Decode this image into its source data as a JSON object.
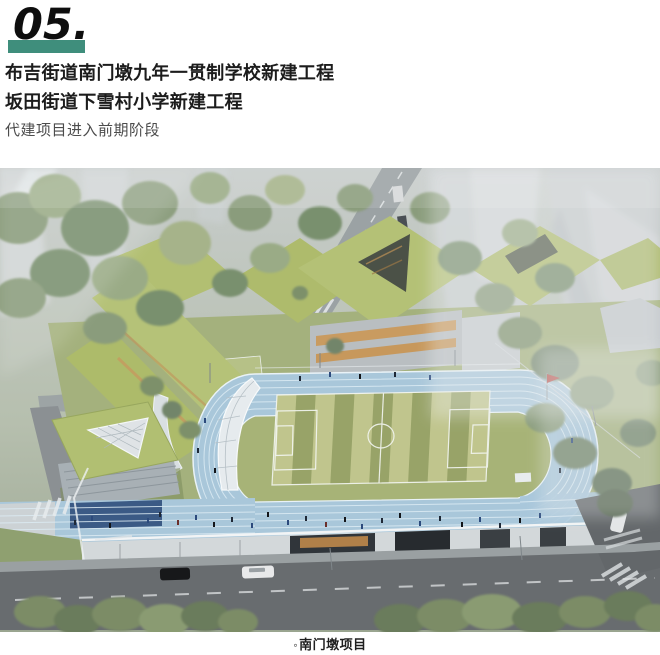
{
  "header": {
    "section_number": "05.",
    "accent_color": "#3F8E7C",
    "title_line1": "布吉街道南门墩九年一贯制学校新建工程",
    "title_line2": "坂田街道下雪村小学新建工程",
    "subtitle": "代建项目进入前期阶段"
  },
  "figure": {
    "alt": "学校新建项目鸟瞰效果图：绿色屋顶教学楼、蓝色环形跑道与足球场",
    "caption_bullet": "◦",
    "caption_text": "南门墩项目",
    "colors": {
      "track_blue": "#A9C7DA",
      "field_green_light": "#C0C58D",
      "field_green_dark": "#98A368",
      "roof_green": "#B1BF72",
      "haze_gray": "#C6CACC",
      "road_gray": "#686C6F"
    }
  }
}
